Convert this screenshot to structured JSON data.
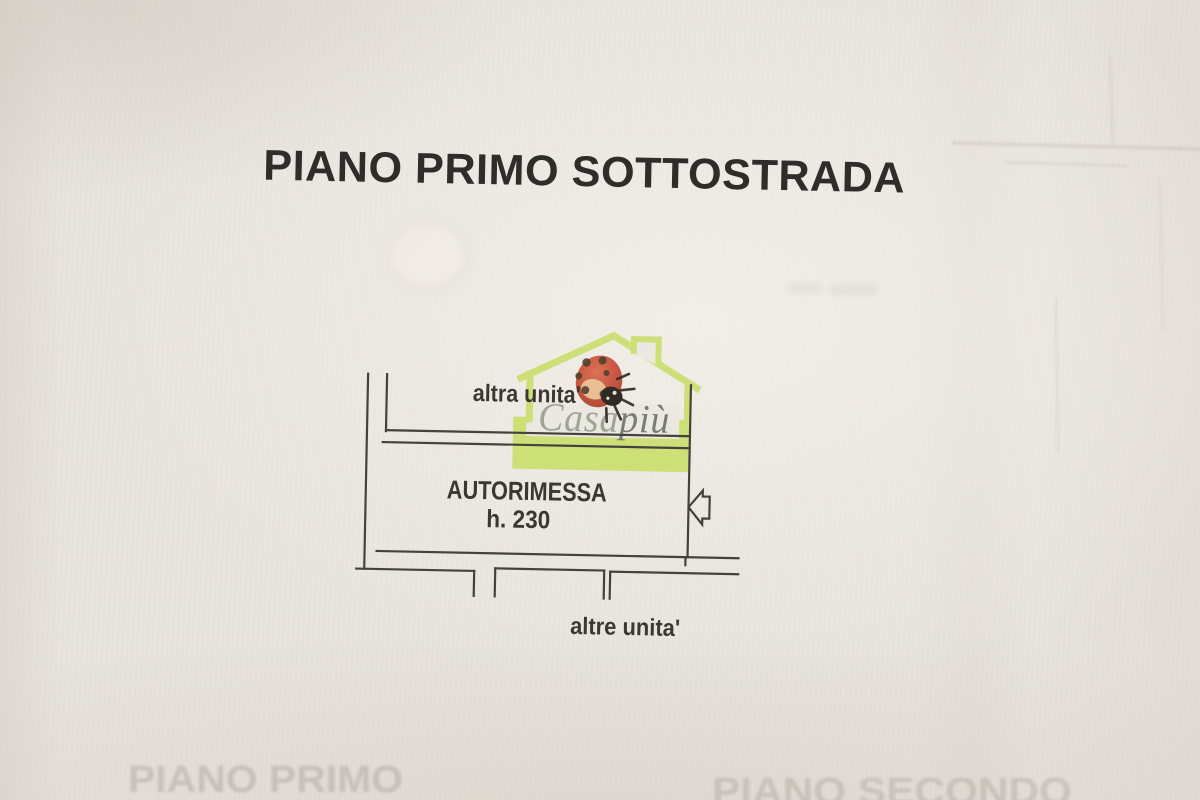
{
  "document": {
    "kind_label": "scanned cadastral floor plan",
    "title": "PIANO PRIMO SOTTOSTRADA"
  },
  "plan": {
    "label_top": "altra unita'",
    "room_label": "AUTORIMESSA",
    "room_height_label": "h. 230",
    "label_bottom": "altre unita'",
    "line_color": "#45423e"
  },
  "watermark": {
    "brand_first": "Casa",
    "brand_second": "più",
    "house_color": "#cbdf6f",
    "brand_first_color": "#9aa08f",
    "brand_second_color": "#6f7569",
    "ladybug_body_color": "#c54c38"
  },
  "bleed_through": {
    "left_text": "PIANO PRIMO",
    "right_text": "PIANO SECONDO"
  },
  "paper": {
    "background_color": "#e8e3dd"
  }
}
